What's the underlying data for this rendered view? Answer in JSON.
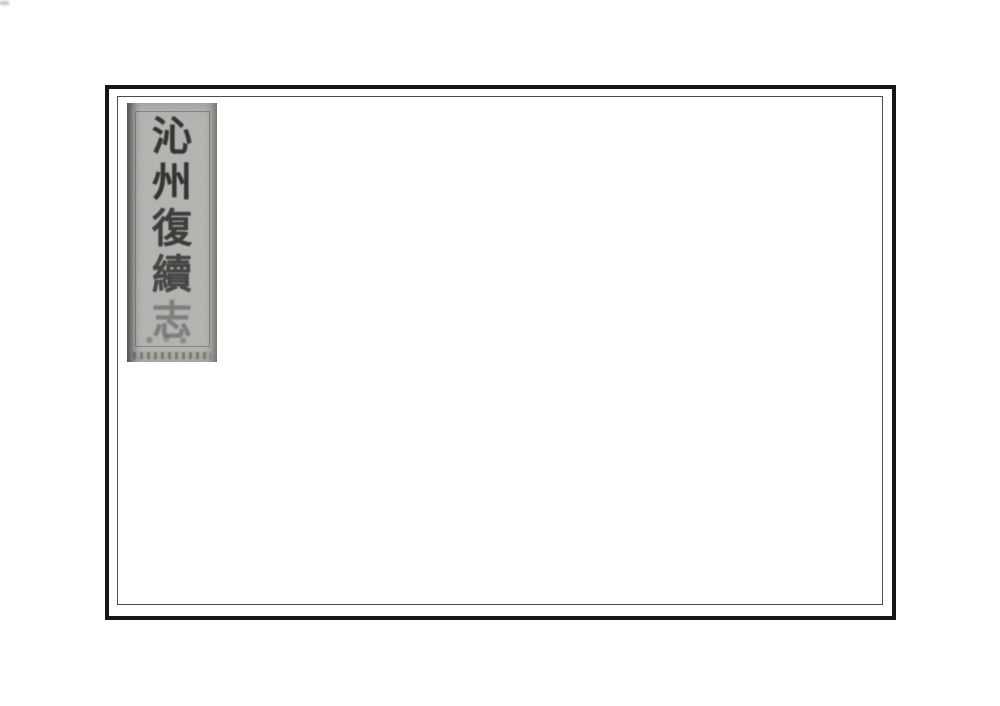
{
  "document": {
    "kind": "scanned-book-cover",
    "page_background": "#ffffff"
  },
  "cover": {
    "outer_border_color": "#161616",
    "inner_border_color": "#4c4c4c",
    "background": "#ffffff"
  },
  "title_label": {
    "title_vertical": "沁州復續志",
    "characters": [
      "沁",
      "州",
      "復",
      "續",
      "志"
    ],
    "background": "#b6b6b3",
    "ink_color": "#2e2c29",
    "orientation": "vertical, read top to bottom"
  }
}
